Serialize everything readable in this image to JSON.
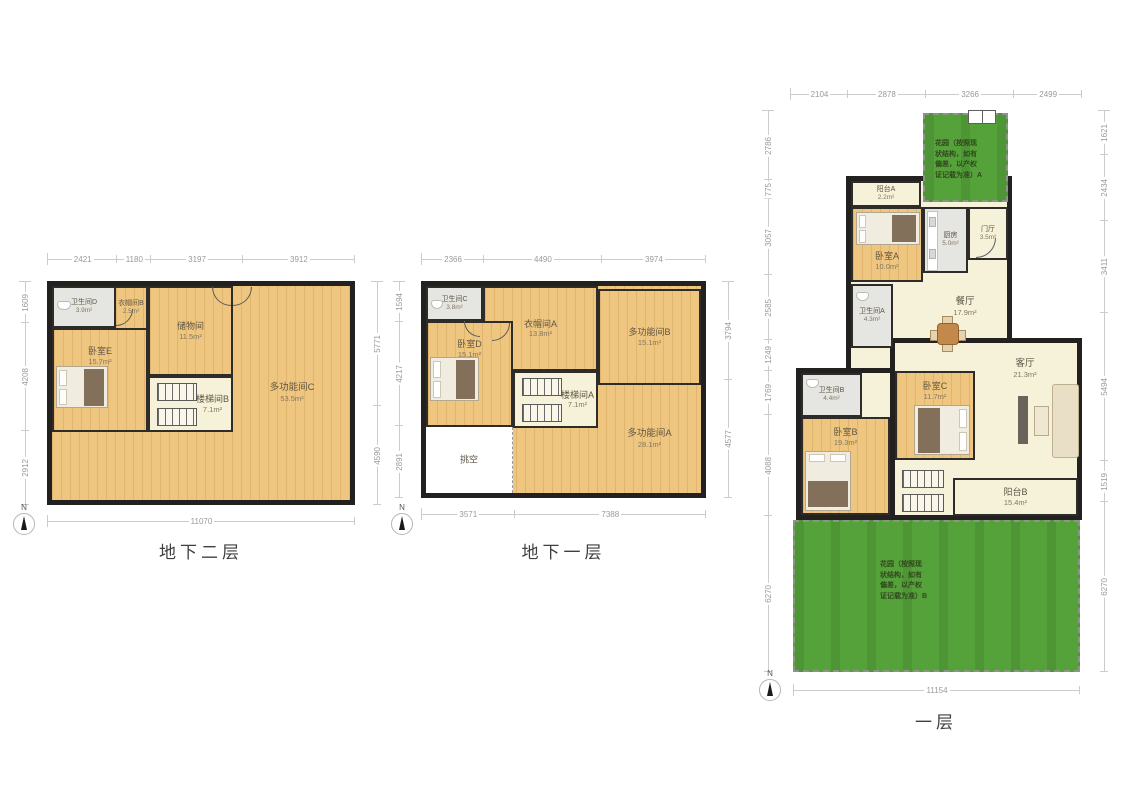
{
  "compass_label": "N",
  "colors": {
    "wood": "#efc67f",
    "cream": "#f6f1d9",
    "gray": "#e5e6e1",
    "garden_green": "#55a23b",
    "wall": "#222120",
    "dim_text": "#9a9a9a"
  },
  "plans": [
    {
      "title": "地下二层",
      "dims": {
        "top": [
          "2421",
          "1180",
          "3197",
          "3912"
        ],
        "left": [
          "1609",
          "4208",
          "2912"
        ],
        "right": [
          "5771",
          "4590"
        ],
        "bottom": [
          "11070"
        ]
      },
      "rooms": {
        "bathroom_d": {
          "name": "卫生间D",
          "area": "3.9m²"
        },
        "cloakroom_b": {
          "name": "衣帽间B",
          "area": "2.5m²"
        },
        "storage": {
          "name": "储物间",
          "area": "11.5m²"
        },
        "bedroom_e": {
          "name": "卧室E",
          "area": "15.7m²"
        },
        "stair_b": {
          "name": "楼梯间B",
          "area": "7.1m²"
        },
        "multi_c": {
          "name": "多功能间C",
          "area": "53.5m²"
        }
      }
    },
    {
      "title": "地下一层",
      "dims": {
        "top": [
          "2366",
          "4490",
          "3974"
        ],
        "left": [
          "1594",
          "4217",
          "2891"
        ],
        "right": [
          "3794",
          "4577"
        ],
        "bottom": [
          "3571",
          "7388"
        ]
      },
      "rooms": {
        "bathroom_c": {
          "name": "卫生间C",
          "area": "3.8m²"
        },
        "cloakroom_a": {
          "name": "衣帽间A",
          "area": "13.8m²"
        },
        "bedroom_d": {
          "name": "卧室D",
          "area": "15.1m²"
        },
        "multi_b": {
          "name": "多功能间B",
          "area": "15.1m²"
        },
        "stair_a": {
          "name": "楼梯间A",
          "area": "7.1m²"
        },
        "multi_a": {
          "name": "多功能间A",
          "area": "28.1m²"
        },
        "void": {
          "name": "挑空"
        }
      }
    },
    {
      "title": "一层",
      "dims": {
        "top": [
          "2104",
          "2878",
          "3266",
          "2499"
        ],
        "left": [
          "2786",
          "775",
          "3057",
          "2585",
          "1249",
          "1769",
          "4088",
          "6270"
        ],
        "right": [
          "1621",
          "2434",
          "3411",
          "5494",
          "1519",
          "6270"
        ],
        "bottom": [
          "11154"
        ]
      },
      "rooms": {
        "garden_a": {
          "name": "花园（按照现\n状结构，如有\n偏差，以产权\n证记载为准）A"
        },
        "balcony_a": {
          "name": "阳台A",
          "area": "2.2m²"
        },
        "bedroom_a": {
          "name": "卧室A",
          "area": "10.0m²"
        },
        "kitchen": {
          "name": "厨房",
          "area": "5.0m²"
        },
        "entry": {
          "name": "门厅",
          "area": "3.5m²"
        },
        "dining": {
          "name": "餐厅",
          "area": "17.9m²"
        },
        "bathroom_a": {
          "name": "卫生间A",
          "area": "4.3m²"
        },
        "bathroom_b": {
          "name": "卫生间B",
          "area": "4.4m²"
        },
        "bedroom_b": {
          "name": "卧室B",
          "area": "19.3m²"
        },
        "bedroom_c": {
          "name": "卧室C",
          "area": "11.7m²"
        },
        "living": {
          "name": "客厅",
          "area": "21.3m²"
        },
        "balcony_b": {
          "name": "阳台B",
          "area": "15.4m²"
        },
        "garden_b": {
          "name": "花园（按照现\n状结构，如有\n偏差，以产权\n证记载为准）B"
        }
      }
    }
  ]
}
